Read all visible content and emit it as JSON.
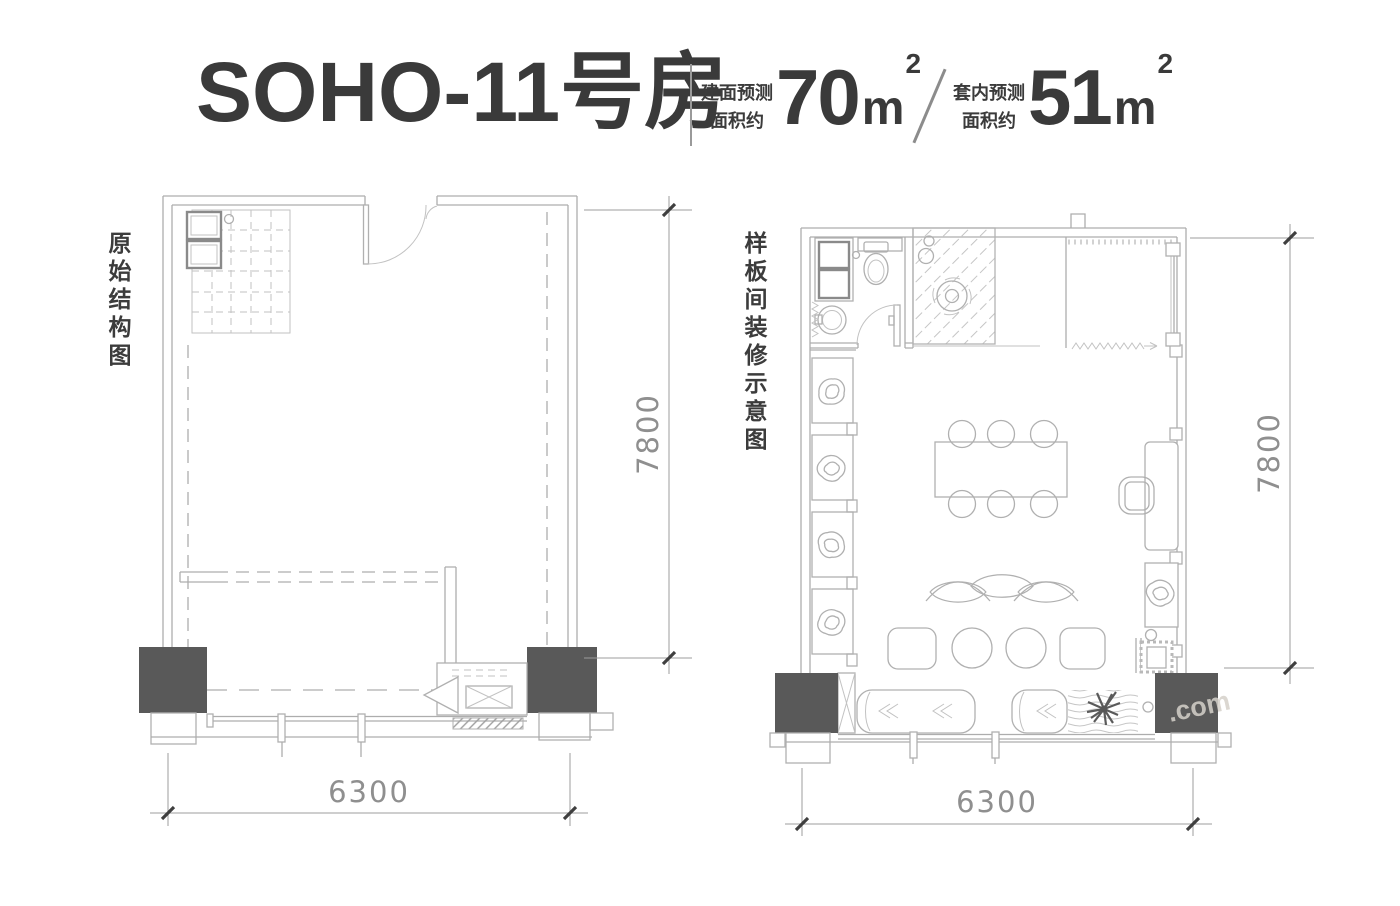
{
  "header": {
    "title": "SOHO-11号房",
    "built_area": {
      "label1": "建面预测",
      "label2": "面积约",
      "value": "70",
      "unit": "m",
      "sup": "2"
    },
    "inner_area": {
      "label1": "套内预测",
      "label2": "面积约",
      "value": "51",
      "unit": "m",
      "sup": "2"
    }
  },
  "plans": {
    "left": {
      "label": "原始结构图",
      "width_mm": "6300",
      "height_mm": "7800"
    },
    "right": {
      "label": "样板间装修示意图",
      "width_mm": "6300",
      "height_mm": "7800"
    }
  },
  "watermark": ".com",
  "colors": {
    "wall_line": "#adadad",
    "column_fill": "#595959",
    "title_text": "#3a3a3a",
    "dimension_text": "#8f8f8f"
  }
}
